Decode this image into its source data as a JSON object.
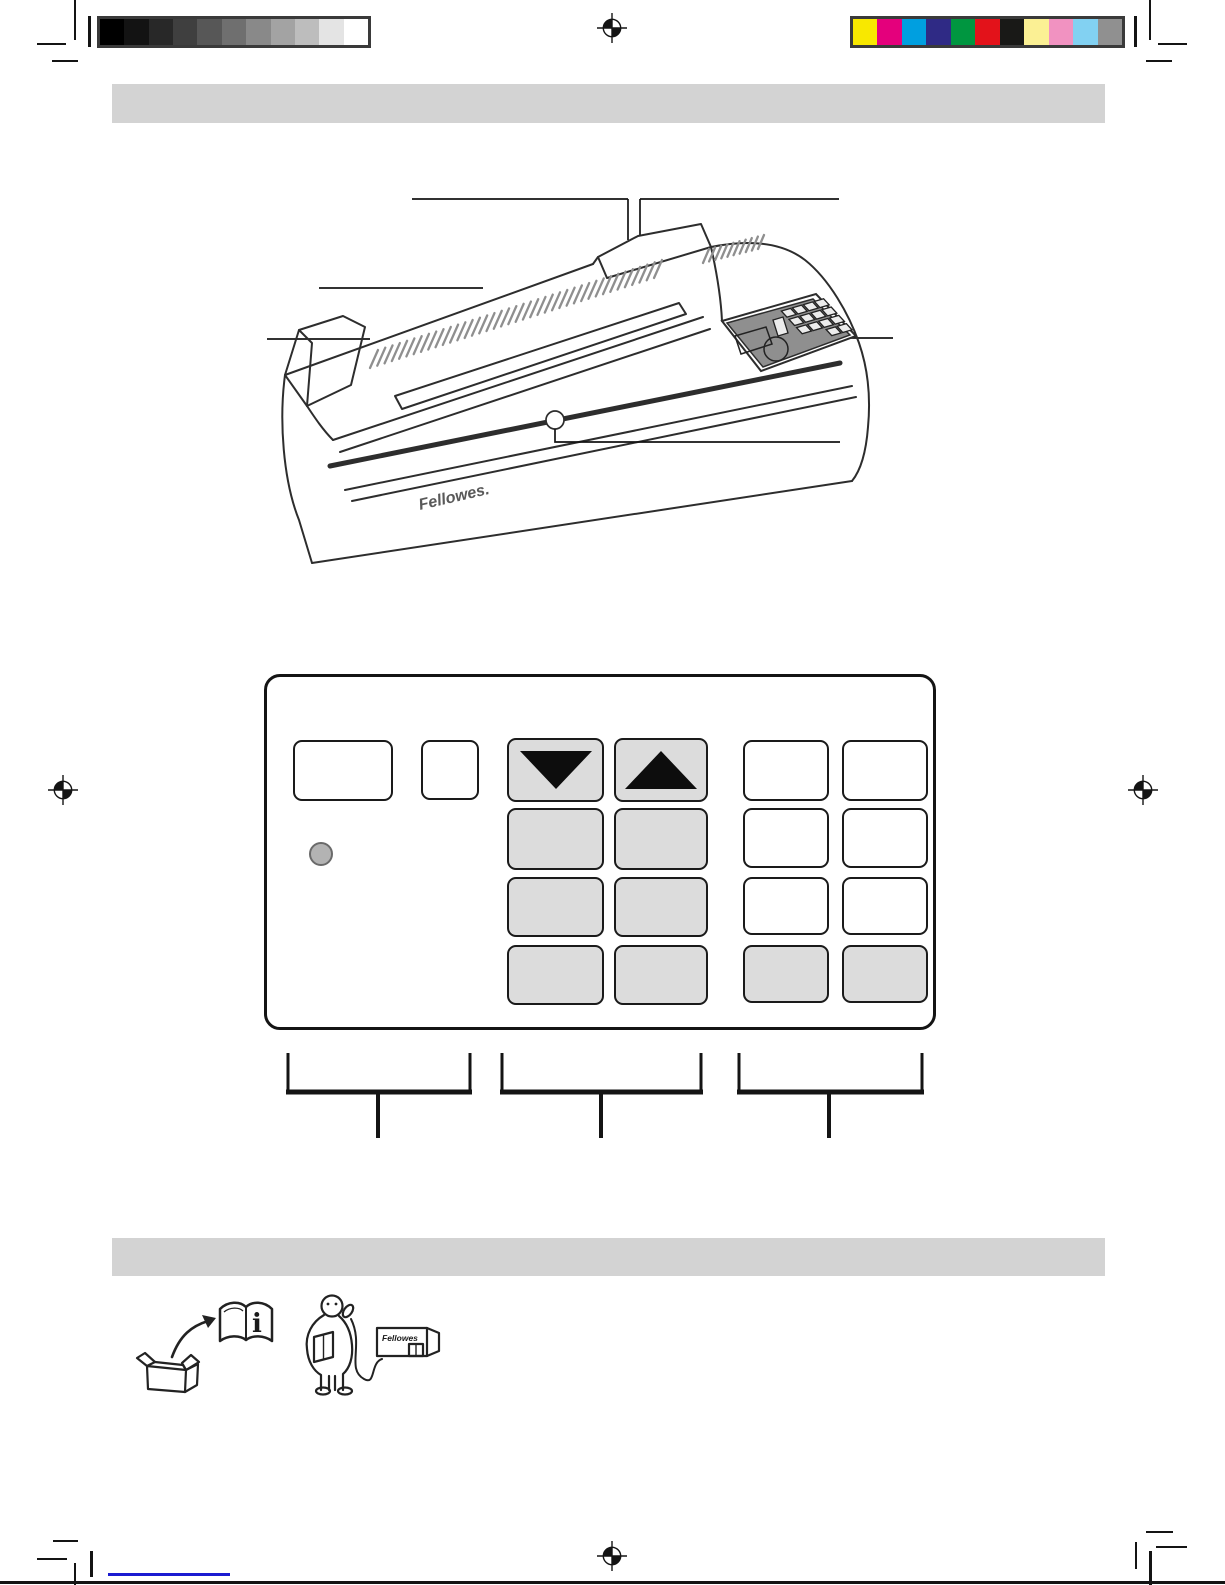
{
  "calibration": {
    "frame_color": "#3a3a3a",
    "grayscale_colors": [
      "#000000",
      "#131313",
      "#282828",
      "#3f3f3f",
      "#575757",
      "#6f6f6f",
      "#898989",
      "#a3a3a3",
      "#bdbdbd",
      "#e4e4e4",
      "#ffffff"
    ],
    "process_colors": [
      "#f8e800",
      "#e4007c",
      "#009fe0",
      "#2f2a85",
      "#009640",
      "#e3121a",
      "#191917",
      "#fbf094",
      "#f192c1",
      "#82d1f2",
      "#909090"
    ]
  },
  "section_bars": {
    "color": "#d3d3d3"
  },
  "laminator_figure": {
    "brand_label": "Fellowes.",
    "line_color": "#2d2d2d",
    "vent_color": "#8f8f8f",
    "panel_fill": "#8f8f8f"
  },
  "control_panel_figure": {
    "button_gray": "#dcdcdc",
    "led_color": "#b3b3b3",
    "buttons": [
      {
        "x": 26,
        "y": 63,
        "w": 100,
        "h": 61,
        "variant": "white",
        "glyph": null,
        "name": "panel-button-wide"
      },
      {
        "x": 154,
        "y": 63,
        "w": 58,
        "h": 60,
        "variant": "white",
        "glyph": null,
        "name": "panel-button"
      },
      {
        "x": 240,
        "y": 61,
        "w": 97,
        "h": 64,
        "variant": "gray",
        "glyph": "down-triangle",
        "name": "down-arrow-button"
      },
      {
        "x": 347,
        "y": 61,
        "w": 94,
        "h": 64,
        "variant": "gray",
        "glyph": "up-triangle",
        "name": "up-arrow-button"
      },
      {
        "x": 476,
        "y": 63,
        "w": 86,
        "h": 61,
        "variant": "white",
        "glyph": null,
        "name": "panel-button"
      },
      {
        "x": 575,
        "y": 63,
        "w": 86,
        "h": 61,
        "variant": "white",
        "glyph": null,
        "name": "panel-button"
      },
      {
        "x": 240,
        "y": 131,
        "w": 97,
        "h": 62,
        "variant": "gray",
        "glyph": null,
        "name": "panel-button"
      },
      {
        "x": 347,
        "y": 131,
        "w": 94,
        "h": 62,
        "variant": "gray",
        "glyph": null,
        "name": "panel-button"
      },
      {
        "x": 476,
        "y": 131,
        "w": 86,
        "h": 60,
        "variant": "white",
        "glyph": null,
        "name": "panel-button"
      },
      {
        "x": 575,
        "y": 131,
        "w": 86,
        "h": 60,
        "variant": "white",
        "glyph": null,
        "name": "panel-button"
      },
      {
        "x": 240,
        "y": 200,
        "w": 97,
        "h": 60,
        "variant": "gray",
        "glyph": null,
        "name": "panel-button"
      },
      {
        "x": 347,
        "y": 200,
        "w": 94,
        "h": 60,
        "variant": "gray",
        "glyph": null,
        "name": "panel-button"
      },
      {
        "x": 476,
        "y": 200,
        "w": 86,
        "h": 58,
        "variant": "white",
        "glyph": null,
        "name": "panel-button"
      },
      {
        "x": 575,
        "y": 200,
        "w": 86,
        "h": 58,
        "variant": "white",
        "glyph": null,
        "name": "panel-button"
      },
      {
        "x": 240,
        "y": 268,
        "w": 97,
        "h": 60,
        "variant": "gray",
        "glyph": null,
        "name": "panel-button"
      },
      {
        "x": 347,
        "y": 268,
        "w": 94,
        "h": 60,
        "variant": "gray",
        "glyph": null,
        "name": "panel-button"
      },
      {
        "x": 476,
        "y": 268,
        "w": 86,
        "h": 58,
        "variant": "gray",
        "glyph": null,
        "name": "panel-button"
      },
      {
        "x": 575,
        "y": 268,
        "w": 86,
        "h": 58,
        "variant": "gray",
        "glyph": null,
        "name": "panel-button"
      }
    ]
  },
  "unpacking_icons": {
    "book_glyph": "i",
    "building_label": "Fellowes"
  },
  "footer": {
    "link_color": "#1b1bd1"
  }
}
